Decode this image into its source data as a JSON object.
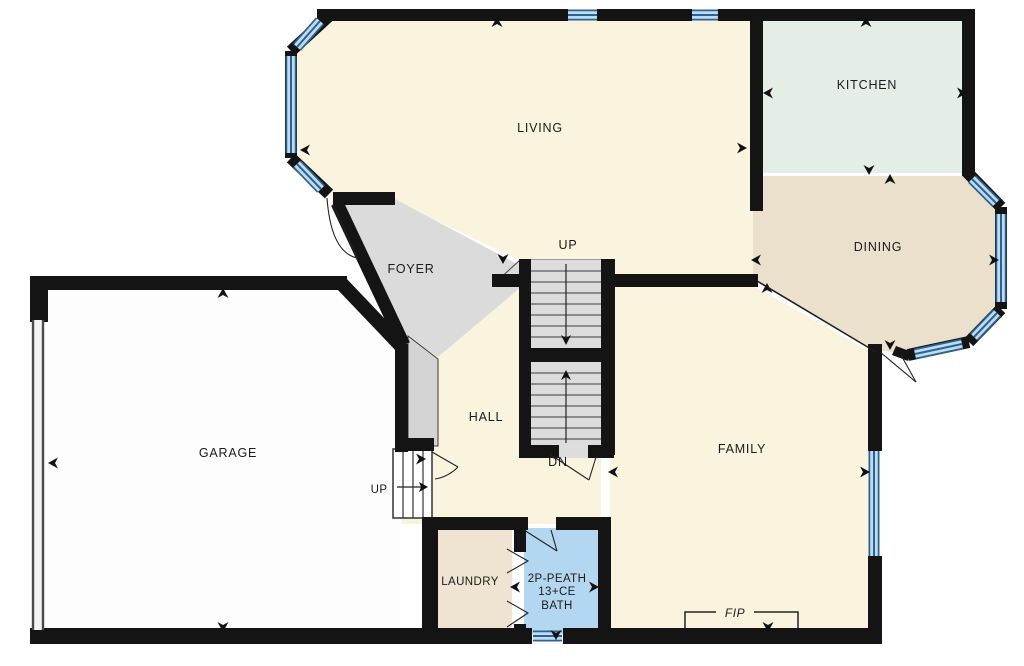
{
  "rooms": {
    "living": {
      "label": "LIVING"
    },
    "kitchen": {
      "label": "KITCHEN"
    },
    "dining": {
      "label": "DINING"
    },
    "foyer": {
      "label": "FOYER"
    },
    "hall": {
      "label": "HALL"
    },
    "garage": {
      "label": "GARAGE"
    },
    "family": {
      "label": "FAMILY"
    },
    "laundry": {
      "label": "LAUNDRY"
    },
    "bath": {
      "label_lines": [
        "2P-PEATH",
        "13+CE",
        "BATH"
      ]
    }
  },
  "stairs": {
    "up_label": "UP",
    "down_label": "DN",
    "garage_up_label": "UP"
  },
  "fireplace": {
    "label": "FIP"
  },
  "colors": {
    "wall": "#141414",
    "floor_cream": "#FAF3DE",
    "floor_kitchen": "#E4EEE7",
    "floor_dining": "#EAE0CC",
    "floor_laundry": "#EFE4D2",
    "floor_bath": "#B3D7F0",
    "floor_gray": "#DBDBDB",
    "floor_closet": "#D4D4D4",
    "floor_garage": "#FDFDFD",
    "window_dark": "#2E618F",
    "window_light": "#BCDCF2"
  }
}
